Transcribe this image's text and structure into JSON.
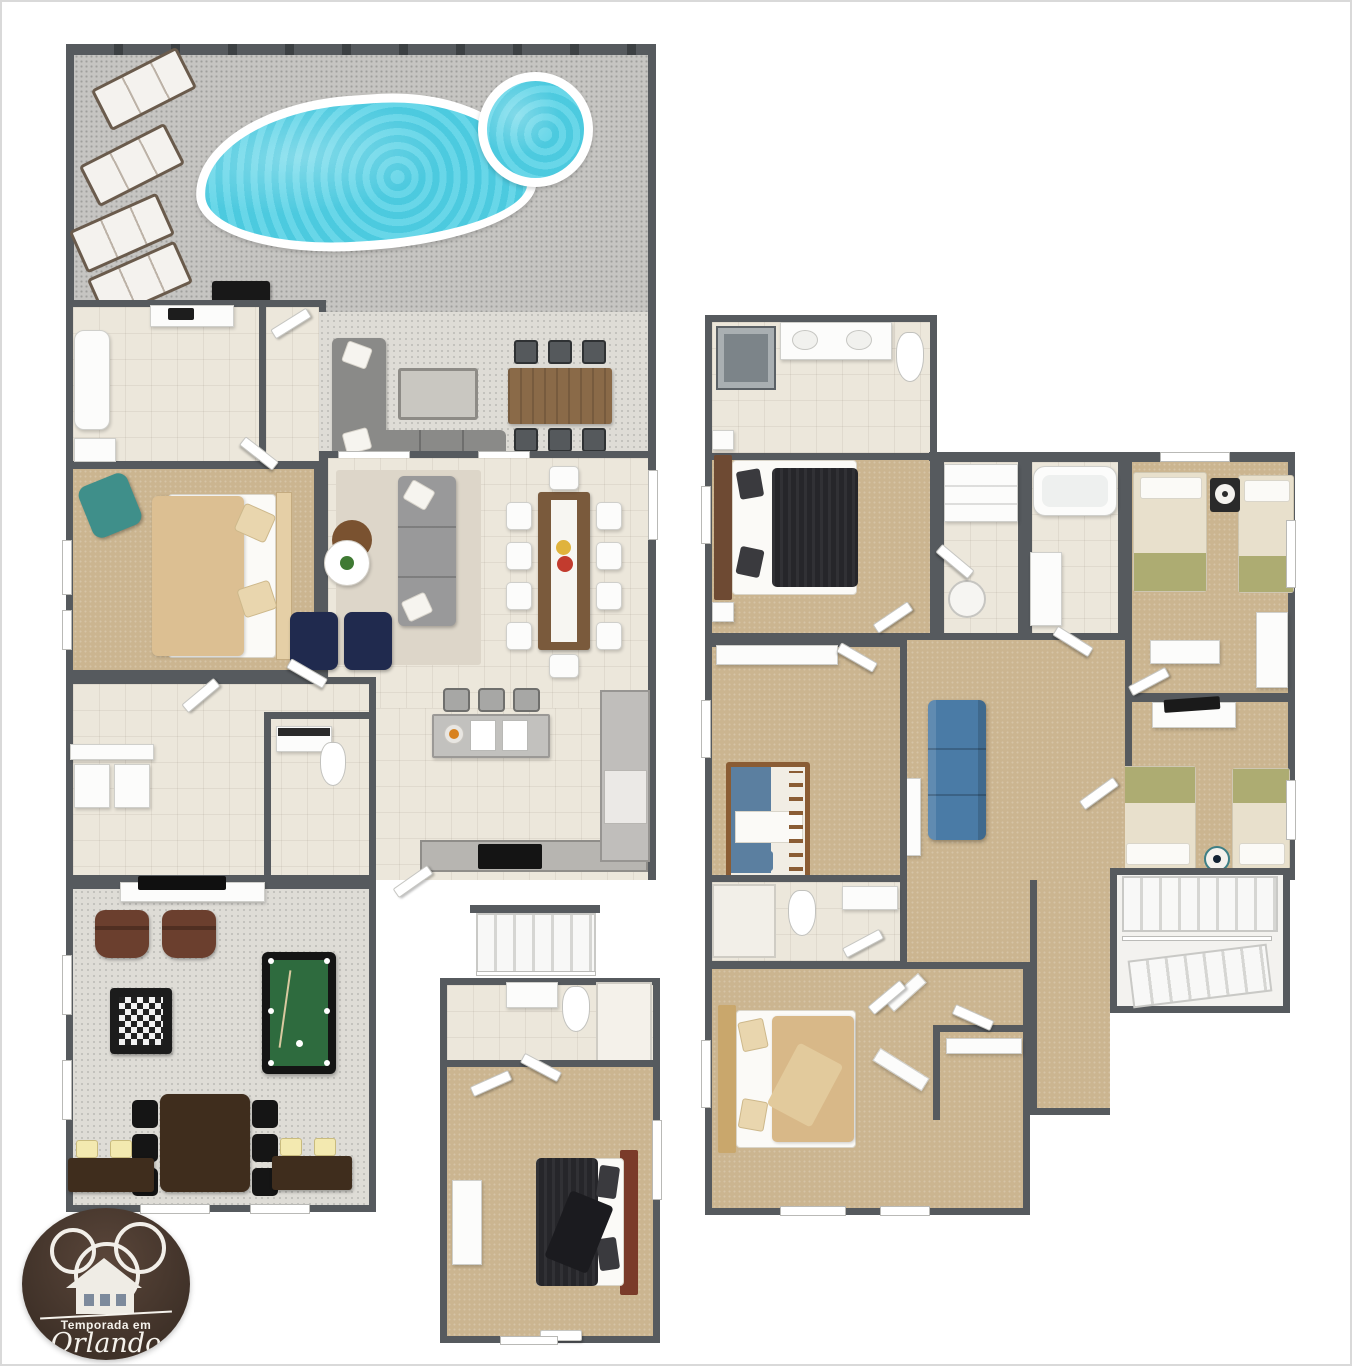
{
  "image": {
    "kind": "3d-floor-plan",
    "subject": "two-story-vacation-villa-with-private-pool",
    "floors": [
      {
        "id": "first-floor",
        "areas": [
          {
            "name": "pool-deck",
            "furniture": [
              "swimming-pool",
              "spa",
              "lounge-chair",
              "lounge-chair",
              "lounge-chair",
              "lounge-chair",
              "bbq-grill"
            ]
          },
          {
            "name": "covered-lanai",
            "furniture": [
              "outdoor-sectional-sofa",
              "coffee-table",
              "outdoor-dining-table",
              "outdoor-chairs"
            ]
          },
          {
            "name": "cabana-bathroom",
            "furniture": [
              "bathtub",
              "shower",
              "vanity"
            ]
          },
          {
            "name": "master-bedroom",
            "furniture": [
              "king-bed",
              "accent-armchair"
            ]
          },
          {
            "name": "living-room",
            "furniture": [
              "sofa",
              "armchair",
              "armchair",
              "round-table",
              "plant"
            ]
          },
          {
            "name": "dining-room",
            "furniture": [
              "dining-table",
              "dining-chairs",
              "flower-centerpiece"
            ]
          },
          {
            "name": "kitchen",
            "furniture": [
              "island-with-double-sink",
              "bar-stools",
              "cooktop-counter",
              "refrigerator",
              "fruit-bowl"
            ]
          },
          {
            "name": "laundry",
            "furniture": [
              "washer",
              "dryer"
            ]
          },
          {
            "name": "hall-bathroom",
            "furniture": [
              "vanity",
              "toilet"
            ]
          },
          {
            "name": "game-room",
            "furniture": [
              "tv",
              "leather-armchair",
              "leather-armchair",
              "chess-table",
              "billiards-table",
              "poker-table",
              "poker-chairs",
              "sideboard-with-lamps",
              "sideboard-with-lamps"
            ]
          },
          {
            "name": "guest-bedroom",
            "furniture": [
              "queen-bed",
              "dresser"
            ]
          },
          {
            "name": "guest-bathroom",
            "furniture": [
              "vanity",
              "toilet",
              "shower"
            ]
          },
          {
            "name": "staircase",
            "furniture": []
          }
        ]
      },
      {
        "id": "second-floor",
        "areas": [
          {
            "name": "master-suite",
            "furniture": [
              "king-bed",
              "nightstand",
              "nightstand"
            ]
          },
          {
            "name": "master-bathroom",
            "furniture": [
              "shower",
              "double-vanity",
              "toilet"
            ]
          },
          {
            "name": "hallway-closets",
            "furniture": [
              "closet-shelves",
              "washer"
            ]
          },
          {
            "name": "bathroom-with-tub",
            "furniture": [
              "bathtub",
              "vanity"
            ]
          },
          {
            "name": "twin-bedroom-front",
            "furniture": [
              "twin-bed",
              "twin-bed",
              "mouse-ears-wall-decor",
              "dresser",
              "dresser"
            ]
          },
          {
            "name": "twin-bedroom-rear",
            "furniture": [
              "twin-bed",
              "twin-bed",
              "tv-console",
              "tv",
              "toy-droid"
            ]
          },
          {
            "name": "loft",
            "furniture": [
              "sofa",
              "console-table"
            ]
          },
          {
            "name": "bunk-bedroom",
            "furniture": [
              "bunk-bed",
              "wardrobe"
            ]
          },
          {
            "name": "hall-bathroom",
            "furniture": [
              "shower",
              "toilet",
              "vanity"
            ]
          },
          {
            "name": "guest-bedroom",
            "furniture": [
              "queen-bed",
              "walk-in-closet",
              "luggage-rack"
            ]
          },
          {
            "name": "staircase",
            "furniture": []
          }
        ]
      }
    ]
  },
  "logo": {
    "text_top": "Temporada em",
    "text_script": "Orlando"
  },
  "palette": {
    "wall": "#565a5e",
    "pool_water": "#57d2e6",
    "pool_deck": "#c6c5c2",
    "patio_floor": "#dedcd6",
    "tile_floor": "#ece7db",
    "carpet": "#cbb590",
    "wood_table": "#8a6a48",
    "billiards_felt": "#2e6b3e",
    "navy_chair": "#202a4e",
    "teal_chair": "#3f8f8a",
    "loft_sofa_blue": "#4a7ba6",
    "leather_chair": "#6b3f2e",
    "dark_wood": "#3f2d1d",
    "logo_brown": "#483828",
    "bed_tan": "#dcbf92",
    "bed_black": "#26262a",
    "bed_olive": "#adac72",
    "headboard_red": "#7a3b2a"
  }
}
